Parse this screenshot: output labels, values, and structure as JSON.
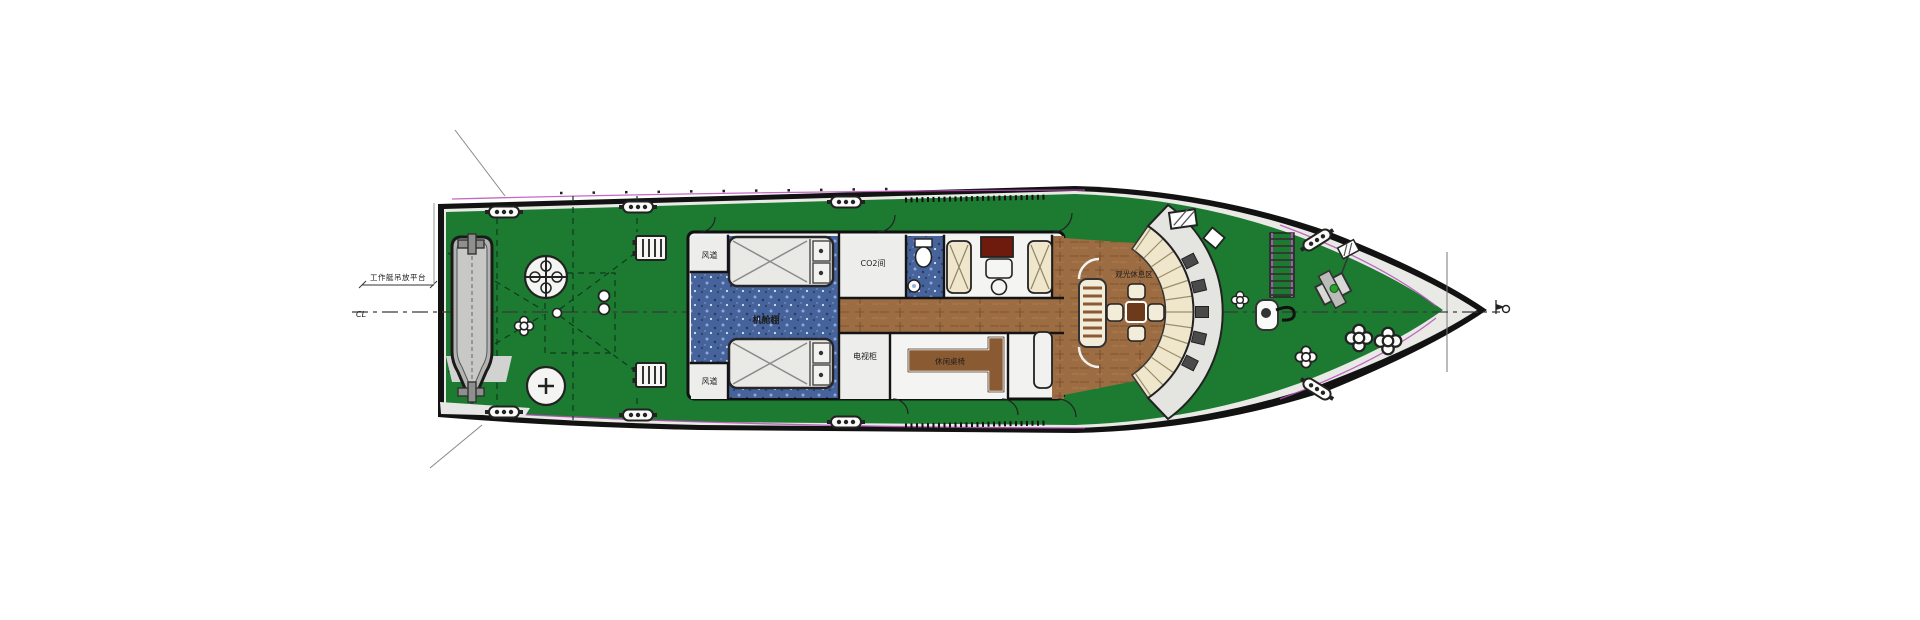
{
  "diagram": {
    "type": "ship-deck-general-arrangement-plan",
    "labels": {
      "davit_platform": "工作艇吊放平台",
      "centerline_mark": "CL",
      "air_duct_top": "风道",
      "air_duct_bottom": "风道",
      "engine_casing": "机舱棚",
      "co2_room": "CO2间",
      "tv_cabinet_room": "电视柜",
      "lounge_table": "休闲桌椅",
      "bow_lounge": "观光休息区"
    },
    "colors": {
      "deck_green": "#1c7a31",
      "hull_black": "#121212",
      "gunwale_white": "#e9e9e6",
      "tile_blue": "#46639b",
      "wood_brown": "#9c6c43",
      "wood_dark": "#8a5a33",
      "seat_cream": "#efe6cb",
      "band_gray": "#e4e4e1",
      "window_gray": "#4a4a4a",
      "boat_gray": "#b3b3b1",
      "table_red": "#6e1a0c",
      "accent_magenta": "#b84fb8"
    },
    "parts": [
      {
        "name": "tender-boat"
      },
      {
        "name": "boat-davit-bitts"
      },
      {
        "name": "capstan"
      },
      {
        "name": "cross-bollard"
      },
      {
        "name": "mooring-fairlead"
      },
      {
        "name": "deck-winch"
      },
      {
        "name": "engine-skylight"
      },
      {
        "name": "toilet"
      },
      {
        "name": "wash-basin"
      },
      {
        "name": "armchair"
      },
      {
        "name": "stool"
      },
      {
        "name": "companionway-stairs"
      },
      {
        "name": "slatted-bench"
      },
      {
        "name": "lounge-table-chairs"
      },
      {
        "name": "curved-bench-seating"
      },
      {
        "name": "windbreak-band"
      },
      {
        "name": "vertical-ladder"
      },
      {
        "name": "anchor-windlass"
      },
      {
        "name": "bow-flag-mark"
      }
    ]
  }
}
